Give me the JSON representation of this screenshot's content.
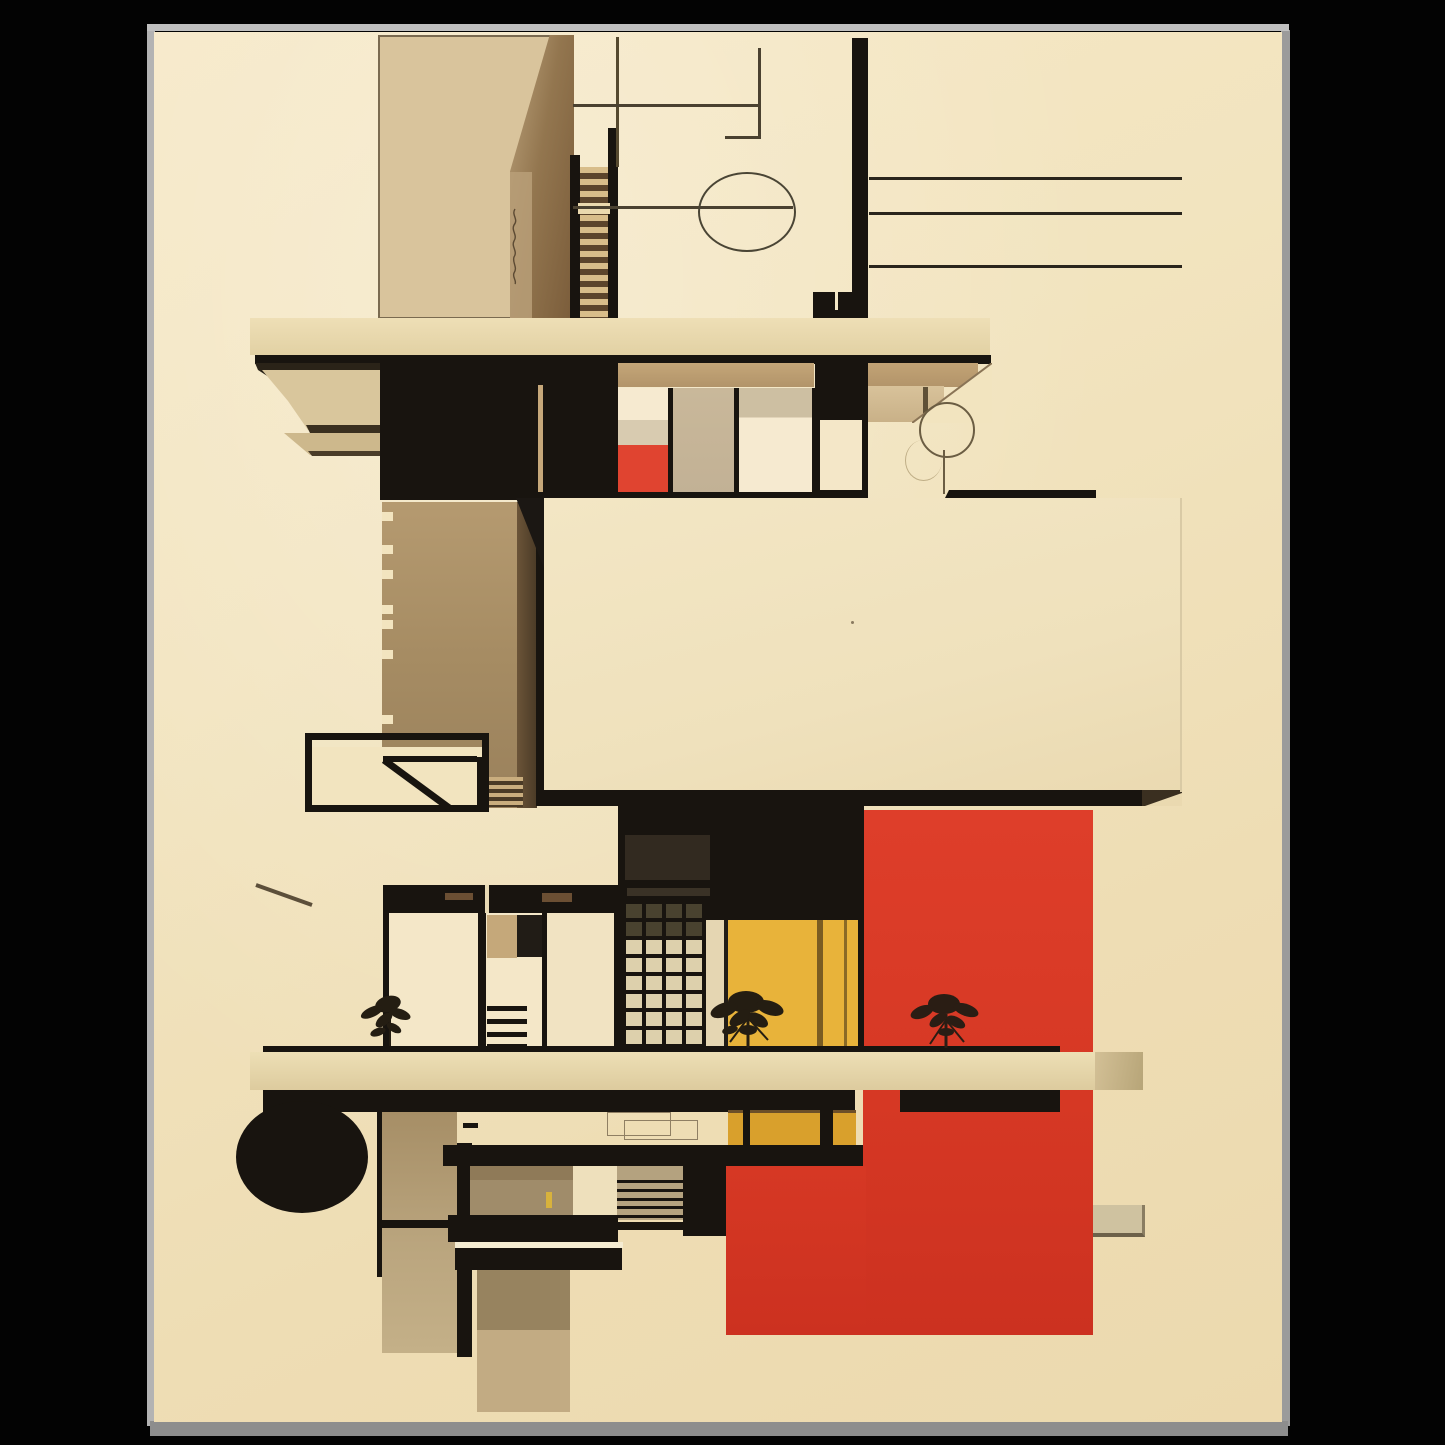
{
  "artwork": {
    "title": "Bauhaus-style abstract architecture poster",
    "medium": "art print on black background",
    "visible_text": "",
    "palette": {
      "canvas": "#030303",
      "posterEdge": "#a6a6a6",
      "posterEdgeDark": "#8c8c8c",
      "cream": "#f2e4bf",
      "creamLight": "#f6ead0",
      "creamPane": "#f4e7c8",
      "slab": "#e9dab0",
      "slabDeep": "#d9c79c",
      "tanPanel": "#d6c09a",
      "tanBand": "#bb9c6f",
      "brown": "#a98f68",
      "brownDark": "#6e5335",
      "brownDeep": "#4a3a26",
      "shadowWall": "#d3bd93",
      "black": "#18140f",
      "blackSoft": "#221d17",
      "panelDark": "#322a20",
      "red": "#d93a26",
      "redDeep": "#c53322",
      "redBright": "#e04430",
      "yellow": "#e8b33a",
      "yellowDeep": "#d9a02c",
      "yellowLine": "#9a7b2f",
      "taupe": "#c3b297",
      "taupeDark": "#9d8a6a",
      "gridCell": "#ddd0ac",
      "gridCellDark": "#49422f",
      "line": "#3f3a2c",
      "lineSoft": "#6a5a42",
      "white": "#f5ecd2",
      "plant": "#241d12"
    },
    "elements": {
      "grid_window": {
        "cols": 4,
        "rows": 8,
        "dark_rows": 2
      },
      "louver_lines": 5,
      "lower_louver_lines": 4,
      "stair_treads": 13,
      "plants": 3,
      "black_dots": 2,
      "right_rule_lines": 3
    }
  }
}
